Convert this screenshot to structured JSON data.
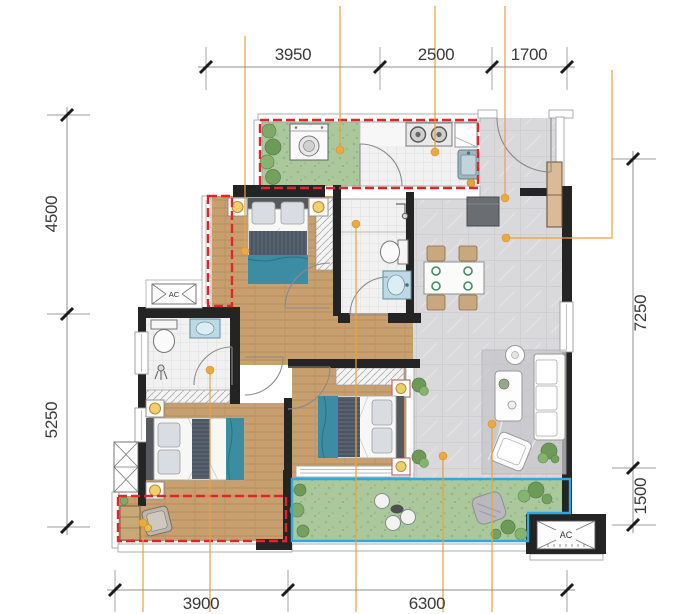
{
  "floorplan": {
    "dimensions": {
      "top": [
        "3950",
        "2500",
        "1700"
      ],
      "left": [
        "4500",
        "5250"
      ],
      "right": [
        "7250",
        "1500"
      ],
      "bottom": [
        "3900",
        "6300"
      ]
    },
    "labels": {
      "ac_main": "AC",
      "ac_side": "AC"
    },
    "colors": {
      "gift_area_red": "#E3242B",
      "balcony_blue": "#2FA8E0",
      "leader_orange": "#E8A33D",
      "wall": "#242424",
      "wood_floor": "#C8A070",
      "tile_floor": "#D9D9DB",
      "green_floor": "#ABC89D",
      "bed_teal": "#3C8CA3"
    }
  }
}
